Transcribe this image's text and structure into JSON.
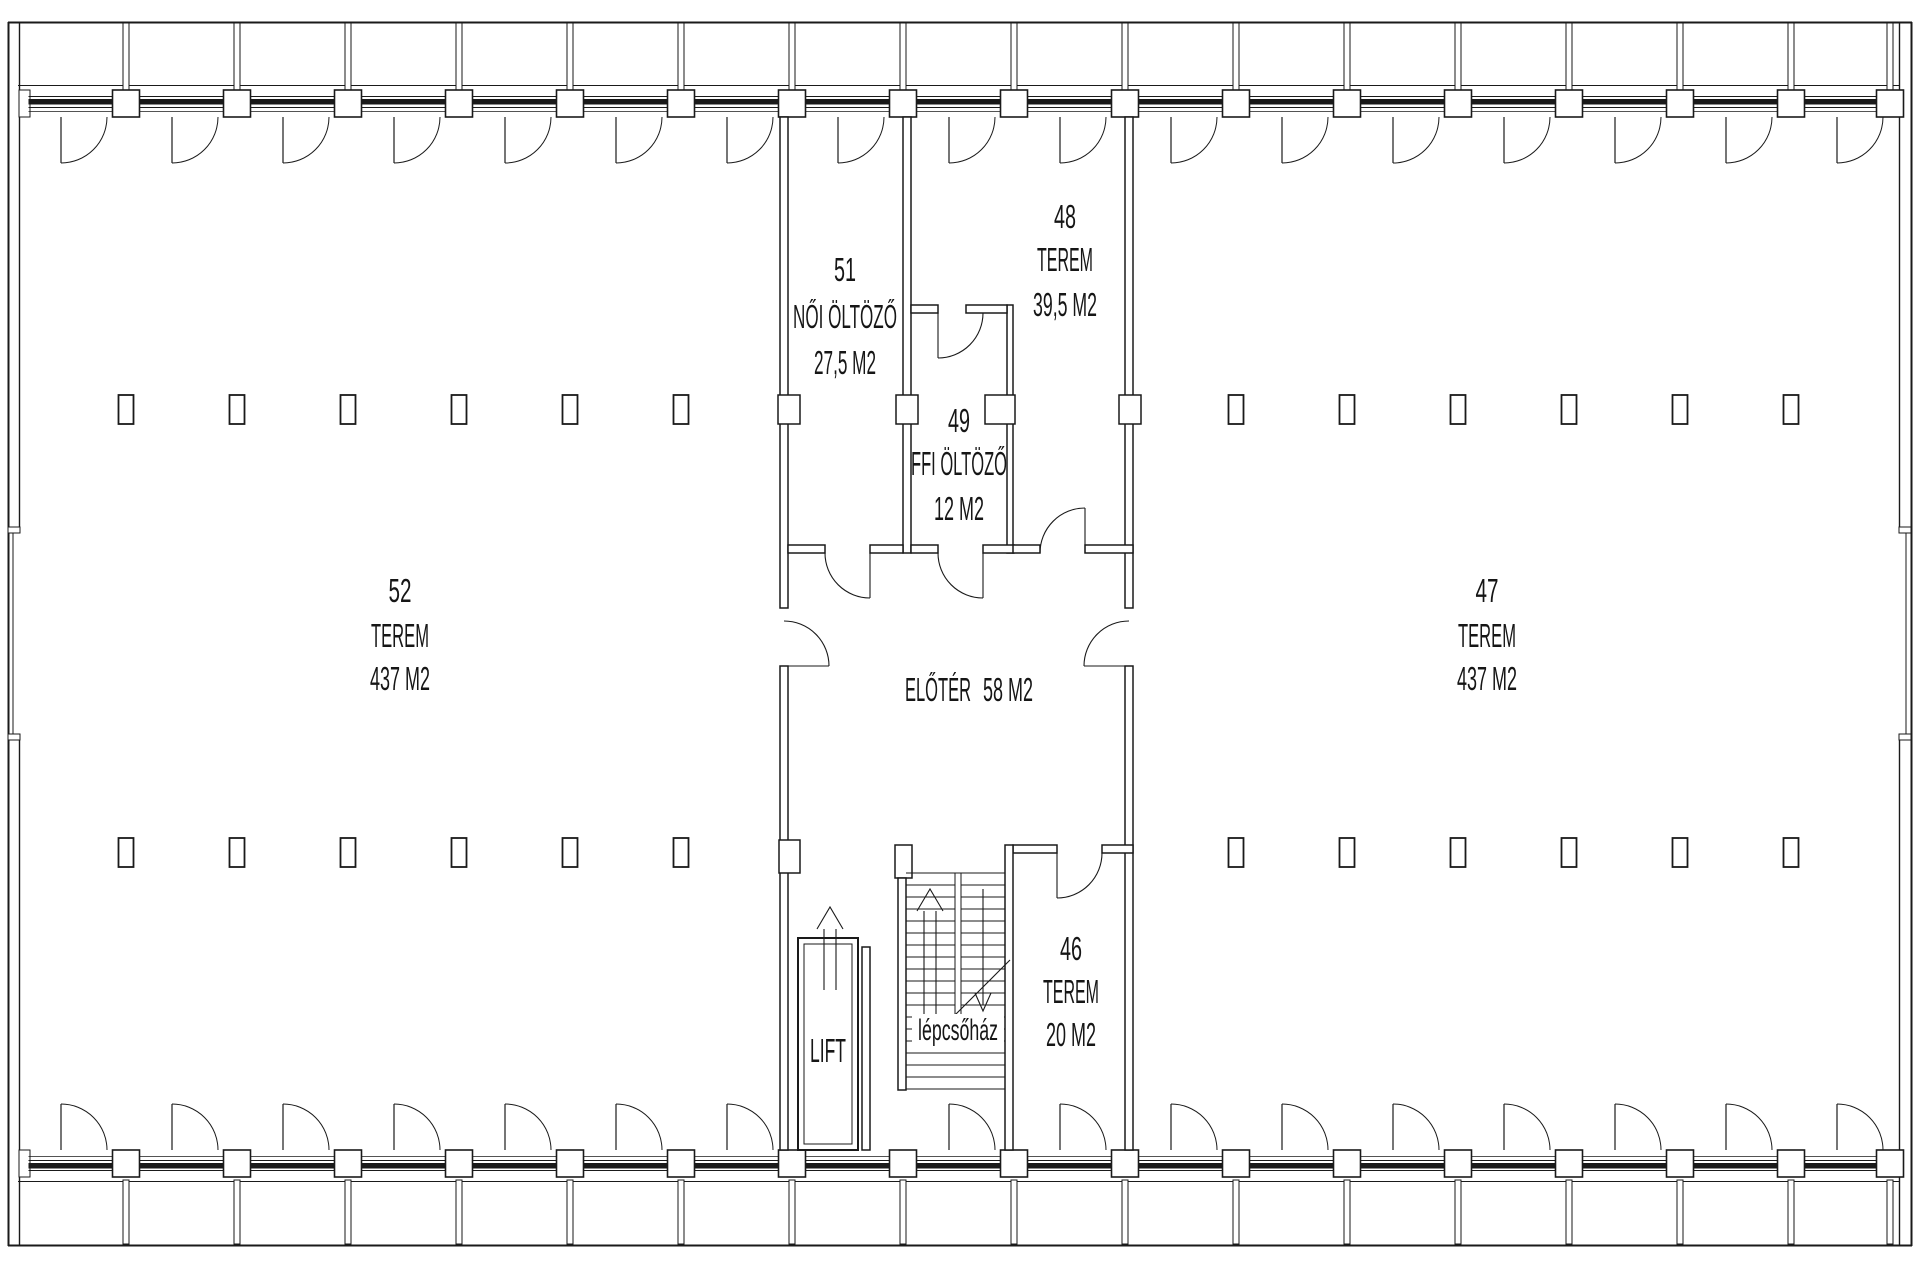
{
  "rooms": {
    "room52": {
      "number": "52",
      "type": "TEREM",
      "area": "437 M2"
    },
    "room47": {
      "number": "47",
      "type": "TEREM",
      "area": "437 M2"
    },
    "room51": {
      "number": "51",
      "type": "NŐI ÖLTÖZŐ",
      "area": "27,5 M2"
    },
    "room48": {
      "number": "48",
      "type": "TEREM",
      "area": "39,5 M2"
    },
    "room49": {
      "number": "49",
      "type": "FFI ÖLTÖZŐ",
      "area": "12 M2"
    },
    "room46": {
      "number": "46",
      "type": "TEREM",
      "area": "20 M2"
    },
    "foyer": {
      "name": "ELŐTÉR",
      "area": "58 M2"
    },
    "lift": {
      "name": "LIFT"
    },
    "stairwell": {
      "name": "lépcsőház"
    }
  },
  "colors": {
    "line": "#1a1a1a",
    "glazing": "#1a1a1a",
    "background": "#ffffff"
  }
}
